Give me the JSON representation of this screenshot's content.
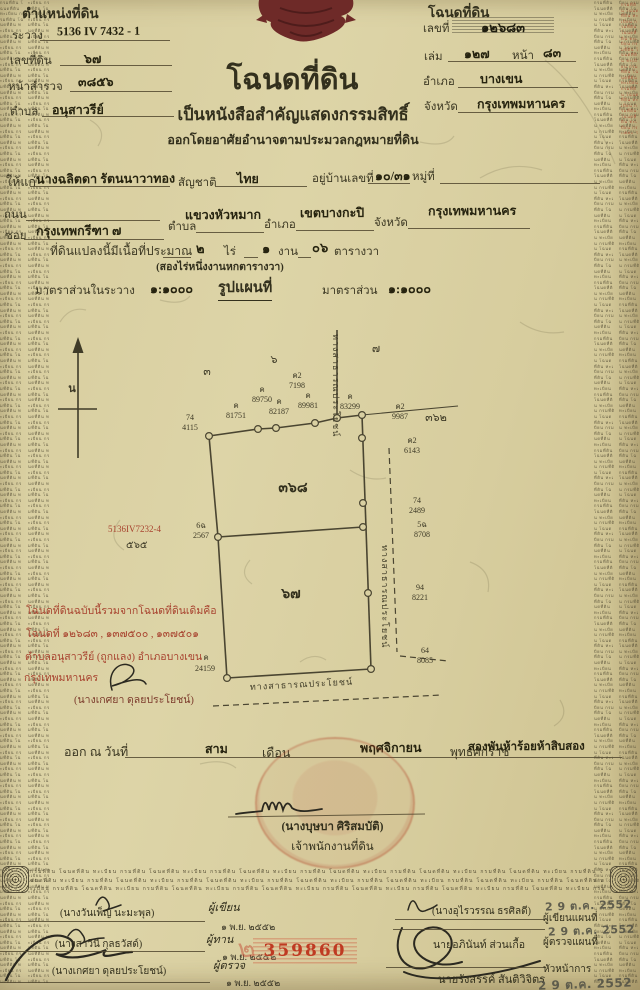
{
  "position_block": {
    "title": "ตำแหน่งที่ดิน",
    "sheet_label": "ระวาง",
    "sheet": "5136 IV 7432 - 1",
    "parcel_label": "เลขที่ดิน",
    "parcel": "๖๗",
    "survey_label": "หน้าสำรวจ",
    "survey": "๓๘๕๖",
    "tambon_label": "ตำบล",
    "tambon": "อนุสาวรีย์"
  },
  "deed_block": {
    "title": "โฉนดที่ดิน",
    "number_label": "เลขที่",
    "number": "๑๒๖๘๓",
    "volume_label": "เล่ม",
    "volume": "๑๒๗",
    "page_label": "หน้า",
    "page": "๘๓",
    "amphoe_label": "อำเภอ",
    "amphoe": "บางเขน",
    "province_label": "จังหวัด",
    "province": "กรุงเทพมหานคร"
  },
  "heading": {
    "title": "โฉนดที่ดิน",
    "subtitle": "เป็นหนังสือสำคัญแสดงกรรมสิทธิ์",
    "subtitle2": "ออกโดยอาศัยอำนาจตามประมวลกฎหมายที่ดิน"
  },
  "grant": {
    "to_label": "ให้แก่",
    "name": "นางฉลิตดา รัตนนาวาทอง",
    "nationality_label": "สัญชาติ",
    "nationality": "ไทย",
    "house_label": "อยู่บ้านเลขที่",
    "house": "๑๐/๓๑",
    "moo_label": "หมู่ที่",
    "road_label": "ถนน",
    "soi_label": "ซอย",
    "soi": "กรุงเทพกรีฑา ๗",
    "tambon_label": "ตำบล",
    "tambon": "แขวงหัวหมาก",
    "amphoe_label": "อำเภอ",
    "amphoe": "เขตบางกะปิ",
    "province_label": "จังหวัด",
    "province": "กรุงเทพมหานคร",
    "area_label": "ที่ดินแปลงนี้มีเนื้อที่ประมาณ",
    "rai": "๒",
    "rai_unit": "ไร่",
    "ngan": "๑",
    "ngan_unit": "งาน",
    "wa": "๐๖",
    "wa_unit": "ตารางวา",
    "area_words": "(สองไร่หนึ่งงานหกตารางวา)"
  },
  "scale": {
    "in_sheet_label": "มาตราส่วนในระวาง",
    "in_sheet": "๑:๑๐๐๐",
    "map_title": "รูปแผนที่",
    "map_label": "มาตราส่วน",
    "map_scale": "๑:๑๐๐๐"
  },
  "map": {
    "north": "น",
    "parcel_upper": "๓๖๘",
    "parcel_lower": "๖๗",
    "adj_1": "๓",
    "adj_2": "๖",
    "adj_3": "๗",
    "adj_4": "๓๖๒",
    "road_top": "ทางสาธารณประโยชน์",
    "road_right": "ทางสาธารณประโยชน์",
    "road_bottom": "ทางสาธารณประโยชน์",
    "sheet_ref": "5136IV7232-4",
    "sheet_ref2": "๕๖๕",
    "markers": [
      {
        "id": "74",
        "no": "4115"
      },
      {
        "id": "ค",
        "no": "81751"
      },
      {
        "id": "ค",
        "no": "89750"
      },
      {
        "id": "ค",
        "no": "82187"
      },
      {
        "id": "ค2",
        "no": "7198"
      },
      {
        "id": "ค",
        "no": "89981"
      },
      {
        "id": "ค",
        "no": "83299"
      },
      {
        "id": "ค2",
        "no": "9987"
      },
      {
        "id": "ค2",
        "no": "6143"
      },
      {
        "id": "74",
        "no": "2489"
      },
      {
        "id": "5ฉ",
        "no": "8708"
      },
      {
        "id": "6ฉ",
        "no": "2567"
      },
      {
        "id": "94",
        "no": "8221"
      },
      {
        "id": "64",
        "no": "8085"
      },
      {
        "id": "ค",
        "no": "24159"
      }
    ]
  },
  "merge_note": {
    "line1": "โฉนดที่ดินฉบับนี้รวมจากโฉนดที่ดินเดิมคือ",
    "line2": "โฉนดที่ ๑๒๖๘๓ , ๑๓๗๕๐๐ , ๑๓๗๕๐๑",
    "line3": "ตำบลอนุสาวรีย์ (ถูกแลง) อำเภอบางเขน",
    "line4": "กรุงเทพมหานคร",
    "signer": "(นางเกศยา ดุลยประโยชน์)"
  },
  "issue": {
    "prefix": "ออก ณ วันที่",
    "day": "สาม",
    "month_label": "เดือน",
    "month": "พฤศจิกายน",
    "era_label": "พุทธศักราช",
    "year": "สองพันห้าร้อยห้าสิบสอง",
    "officer": "(นางบุษบา ศิริสมบัติ)",
    "officer_title": "เจ้าพนักงานที่ดิน"
  },
  "footer": {
    "serial": "359860",
    "note": "๒",
    "left": [
      {
        "name": "(นางวันเพ็ญ นะมะพุล)",
        "role": "ผู้เขียน",
        "date": "๑ พ.ย. ๒๕๕๒"
      },
      {
        "name": "(นางสาวินี กุลธวัสด์)",
        "role": "ผู้ทาน",
        "date": "๑ พ.ย. ๒๕๕๒"
      },
      {
        "name": "(นางเกศยา ดุลยประโยชน์)",
        "role": "ผู้ตรวจ",
        "date": "๑ พ.ย. ๒๕๕๒"
      }
    ],
    "right": [
      {
        "name": "(นางอุไรวรรณ ธรศิลดี)",
        "role": "ผู้เขียนแผนที่",
        "stamp": "2 9 ต.ค. 2552"
      },
      {
        "name": "นายอภินันท์ ส่วนเกื้อ",
        "role": "ผู้ตรวจแผนที่",
        "stamp": "2 9 ต.ค. 2552"
      },
      {
        "name": "นายรังสรรค์ สันติวิจิตร",
        "role": "หัวหน้าการ",
        "stamp": "2 9 ต.ค. 2552"
      }
    ]
  },
  "decor": {
    "microtext": "กรมที่ดิน โฉนดที่ดิน ทะเบียน "
  }
}
